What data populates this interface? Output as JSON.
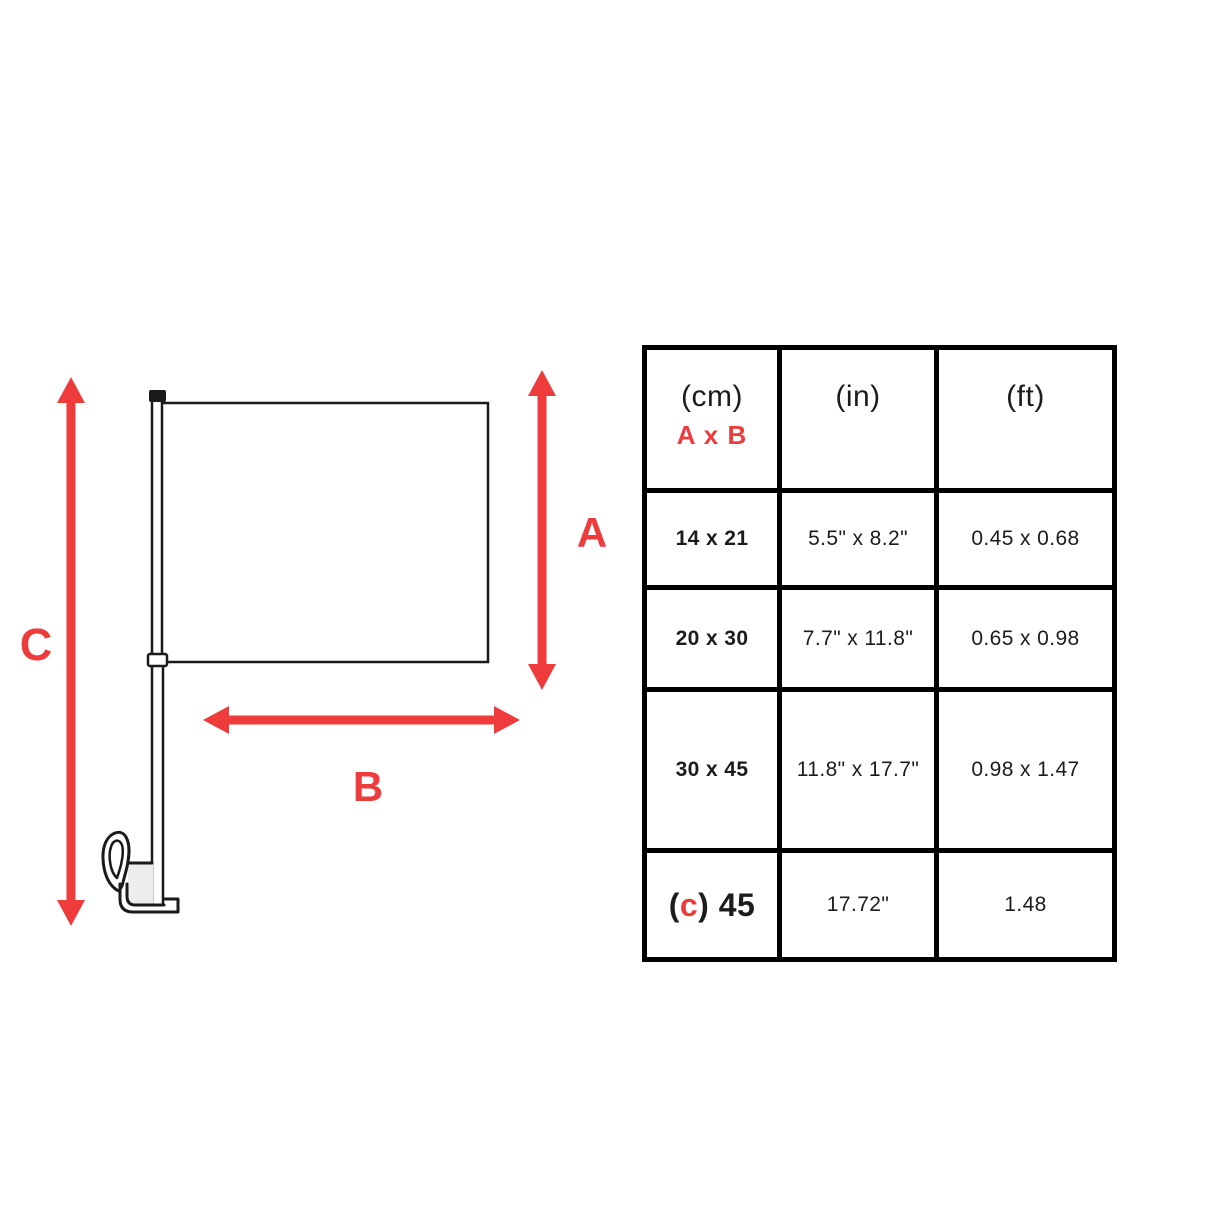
{
  "colors": {
    "accent_red": "#ee3b3c",
    "line_black": "#1a1a1a",
    "table_border": "#000000"
  },
  "diagram": {
    "label_a": "A",
    "label_b": "B",
    "label_c": "C",
    "parts": {
      "flag": "flag-rectangle",
      "pole": "flag-pole",
      "clip": "window-clip",
      "arrows": [
        "vertical-arrow-a",
        "horizontal-arrow-b",
        "vertical-arrow-c"
      ]
    }
  },
  "table": {
    "header": {
      "col1_line1": "(cm)",
      "col1_line2": "A x B",
      "col2": "(in)",
      "col3": "(ft)"
    },
    "rows": [
      {
        "cm": "14 x 21",
        "in": "5.5\" x 8.2\"",
        "ft": "0.45 x 0.68"
      },
      {
        "cm": "20 x 30",
        "in": "7.7\" x 11.8\"",
        "ft": "0.65 x 0.98"
      },
      {
        "cm": "30 x 45",
        "in": "11.8\" x 17.7\"",
        "ft": "0.98 x 1.47"
      },
      {
        "cm_open": "(",
        "cm_c": "c",
        "cm_close": ") 45",
        "in": "17.72\"",
        "ft": "1.48"
      }
    ]
  }
}
